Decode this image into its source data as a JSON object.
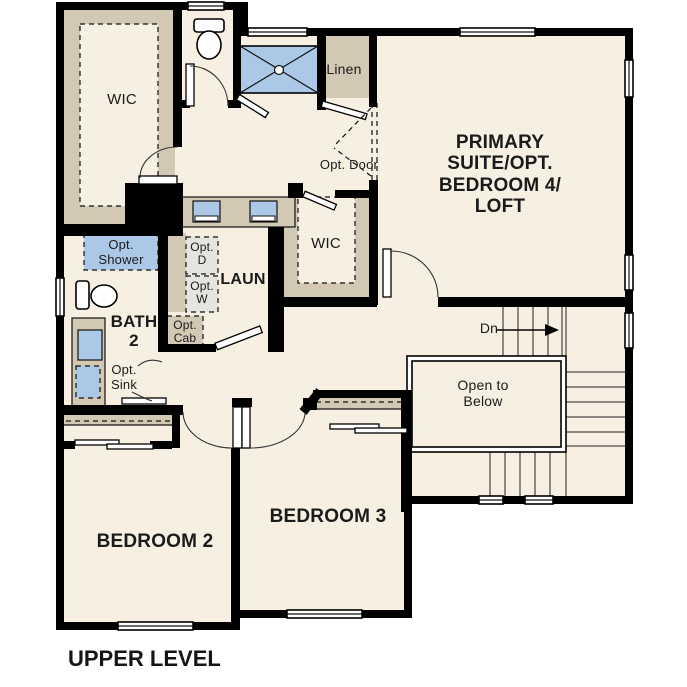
{
  "title": "UPPER LEVEL",
  "colors": {
    "background": "#ffffff",
    "floor": "#f6efe2",
    "accent_tan": "#d3c8b4",
    "accent_blue": "#abc9e7",
    "appliance_gray": "#e4e4e0",
    "wall": "#000000"
  },
  "rooms": {
    "wic1": {
      "label": "WIC"
    },
    "linen": {
      "label": "Linen"
    },
    "primary": {
      "label": "PRIMARY SUITE/OPT. BEDROOM 4/ LOFT"
    },
    "wic2": {
      "label": "WIC"
    },
    "bath2": {
      "label": "BATH 2"
    },
    "laundry": {
      "label": "LAUN"
    },
    "bedroom2": {
      "label": "BEDROOM 2"
    },
    "bedroom3": {
      "label": "BEDROOM 3"
    }
  },
  "annotations": {
    "opt_door": "Opt. Door",
    "opt_shower": "Opt. Shower",
    "opt_dryer": "Opt. D",
    "opt_washer": "Opt. W",
    "opt_cab": "Opt. Cab",
    "opt_sink": "Opt. Sink",
    "stairs_down": "Dn",
    "open_to_below": "Open to Below"
  }
}
